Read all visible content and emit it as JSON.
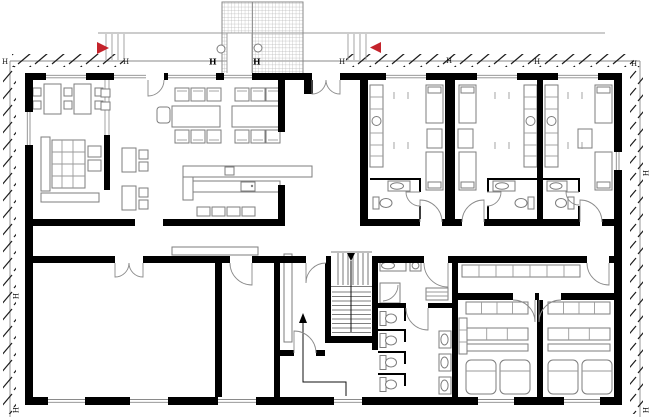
{
  "page": {
    "background": "#ffffff"
  },
  "colors": {
    "wall": "#000000",
    "line": "#777777",
    "furn": "#7d7d7d",
    "thin": "#9a9a9a",
    "hatch": "#1c1c1c",
    "red": "#c4232b",
    "grid": "#b9b9b9",
    "stairline": "#555555",
    "route": "#111111"
  },
  "markers": {
    "boundary_label": "H",
    "canopy_column_label": "H"
  },
  "symbols": {
    "entry_arrow_west": "right-pointing-triangle",
    "entry_arrow_east": "left-pointing-triangle",
    "stair_direction_marker": "down-pointing-triangle",
    "route_direction_marker": "up-pointing-triangle"
  }
}
